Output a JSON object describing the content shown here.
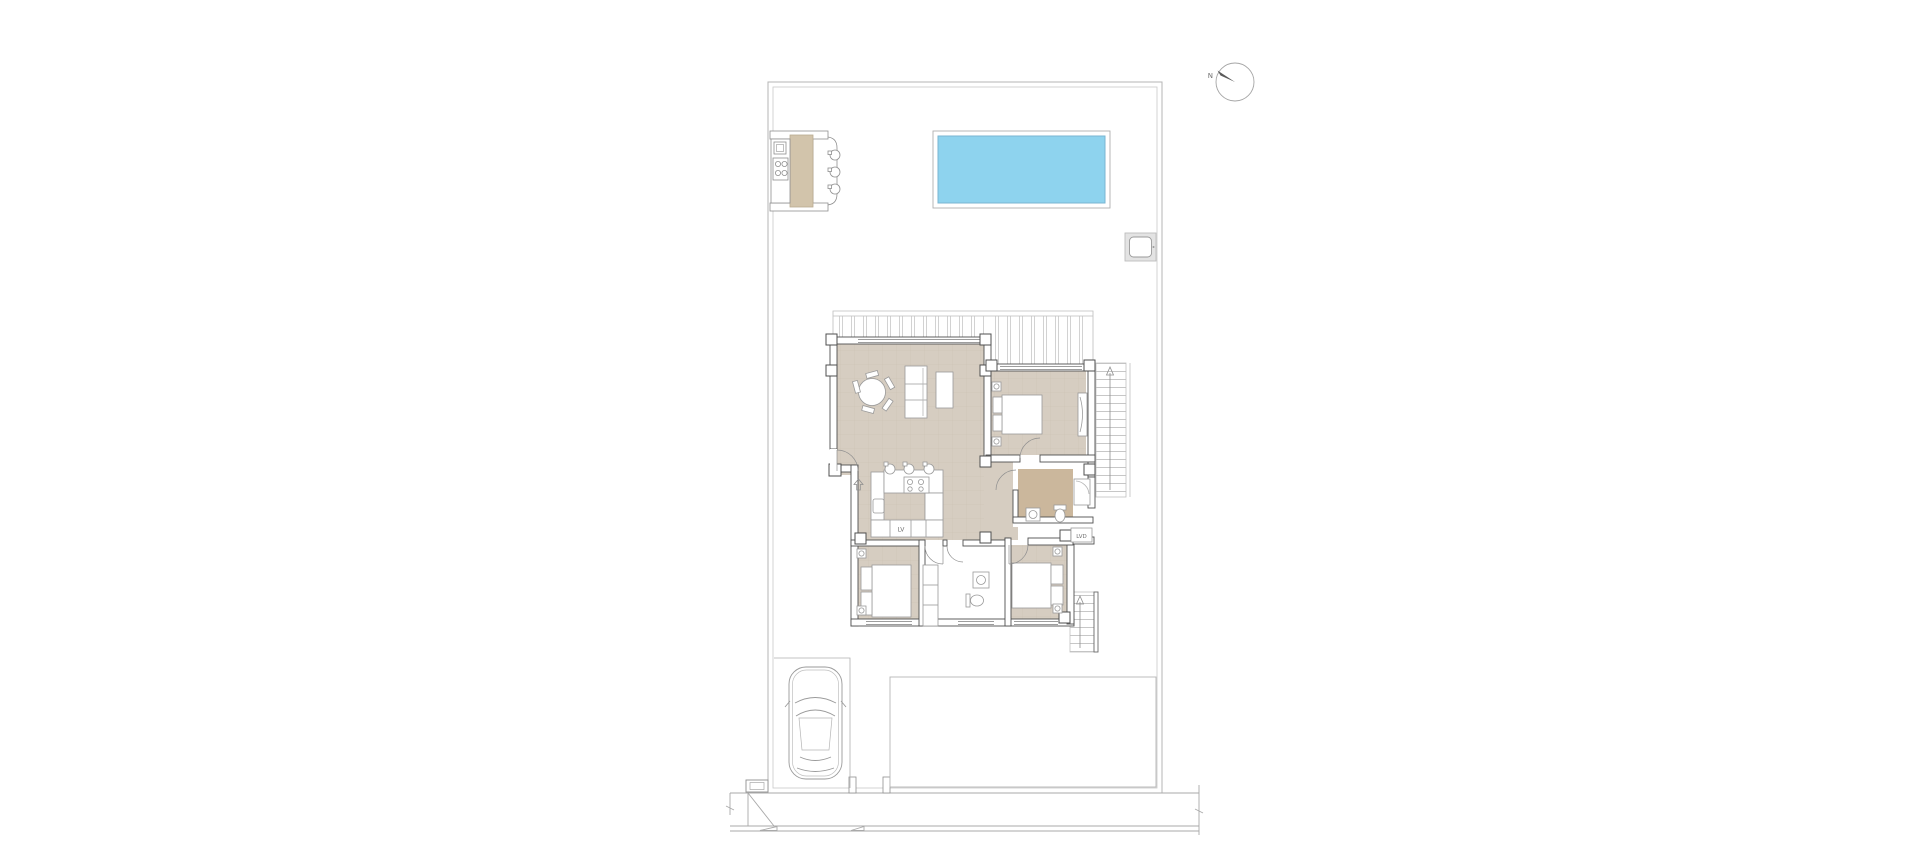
{
  "labels": {
    "north": "N",
    "dishwasher": "LV",
    "laundry": "LVD"
  },
  "colors": {
    "pool_water": "#8ed3ee",
    "pool_edge": "#79b6d2",
    "floor": "#d6cdc1",
    "bathroom_floor": "#cbb79c",
    "breakfast_bar": "#d2c4ab",
    "wall_line": "#4f4f4f",
    "thin_line": "#9a9a9a",
    "boundary_line": "#b5b5b5",
    "label_text": "#6f6f6f"
  }
}
